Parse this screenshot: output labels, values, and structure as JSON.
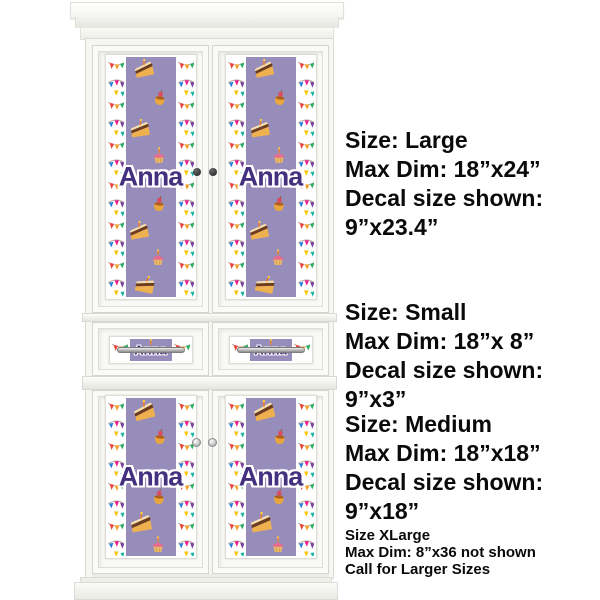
{
  "product_preview": {
    "name_text": "Anna",
    "theme": "happy-birthday personalized decal set on white armoire cabinet",
    "colors": {
      "decal_band_purple": "#978dbb",
      "name_text_purple": "#43307f",
      "name_outline_white": "#ffffff",
      "furniture_white": "#fafaf7",
      "banner_flag_colors": [
        "#e8433b",
        "#f39c1f",
        "#7b3fa0",
        "#27ae60",
        "#e91e8c",
        "#2980d9",
        "#f5c400",
        "#16b5a4"
      ]
    },
    "icons": {
      "cake_slice": "cake-slice-icon",
      "custard_cherry": "custard-cherry-icon",
      "cupcake_candle": "cupcake-candle-icon",
      "party_banner": "party-banner-garland-icon",
      "door_knob_dark": "door-knob-icon",
      "door_knob_silver": "door-knob-icon",
      "drawer_handle": "drawer-pull-icon"
    }
  },
  "annotations": {
    "size_blocks": [
      {
        "lines": [
          "Size: Large",
          "Max Dim: 18”x24”",
          "Decal size shown:",
          "9”x23.4”"
        ]
      },
      {
        "lines": [
          "Size: Small",
          "Max Dim: 18”x 8”",
          "Decal size shown:",
          "9”x3”"
        ]
      },
      {
        "lines": [
          "Size: Medium",
          "Max Dim: 18”x18”",
          "Decal size shown:",
          "9”x18”"
        ]
      }
    ],
    "xlarge_note": {
      "lines": [
        "Size XLarge",
        "Max Dim: 8”x36 not shown",
        "Call for Larger Sizes"
      ]
    }
  }
}
